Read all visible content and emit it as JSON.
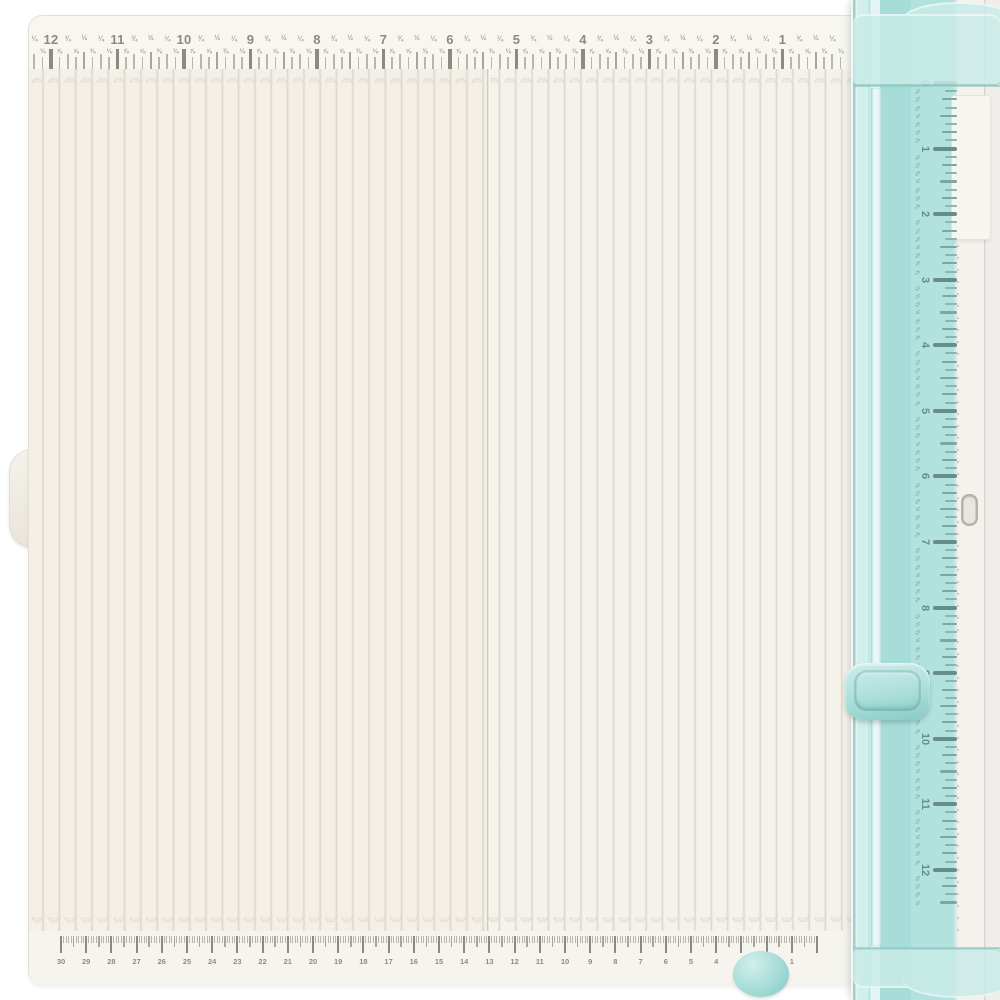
{
  "scene": {
    "description_label": "paper trimmer and scoring board",
    "accent_teal": "#a9ded9",
    "accent_teal_light": "#d3efec",
    "accent_teal_dark": "#89cac3",
    "board_color": "#f2efe8",
    "tick_color": "#8d8a82",
    "tick_color_light": "#b9b6ad"
  },
  "fraction_glyphs": {
    "875": "⅞",
    "750": "¾",
    "625": "⅝",
    "500": "½",
    "375": "⅜",
    "250": "¼",
    "125": "⅛"
  },
  "rulers": {
    "top": {
      "unit": "inches",
      "direction": "descending",
      "numbers": [
        "12",
        "11",
        "10",
        "9",
        "8",
        "7",
        "6",
        "5",
        "4",
        "3",
        "2",
        "1"
      ],
      "fractions_upper_row": [
        "¾",
        "½",
        "¼"
      ],
      "fractions_lower_row": [
        "⅞",
        "⅝",
        "⅜",
        "⅛"
      ]
    },
    "side": {
      "unit": "inches",
      "direction": "ascending",
      "numbers": [
        "0",
        "1",
        "2",
        "3",
        "4",
        "5",
        "6",
        "7",
        "8",
        "9",
        "10",
        "11",
        "12"
      ],
      "end_fraction": "½"
    },
    "bottom": {
      "unit": "cm",
      "direction": "descending",
      "numbers": [
        "30",
        "29",
        "28",
        "27",
        "26",
        "25",
        "24",
        "23",
        "22",
        "21",
        "20",
        "19",
        "18",
        "17",
        "16",
        "15",
        "14",
        "13",
        "12",
        "11",
        "10",
        "9",
        "8",
        "7",
        "6",
        "5",
        "4",
        "3",
        "2",
        "1"
      ]
    }
  }
}
